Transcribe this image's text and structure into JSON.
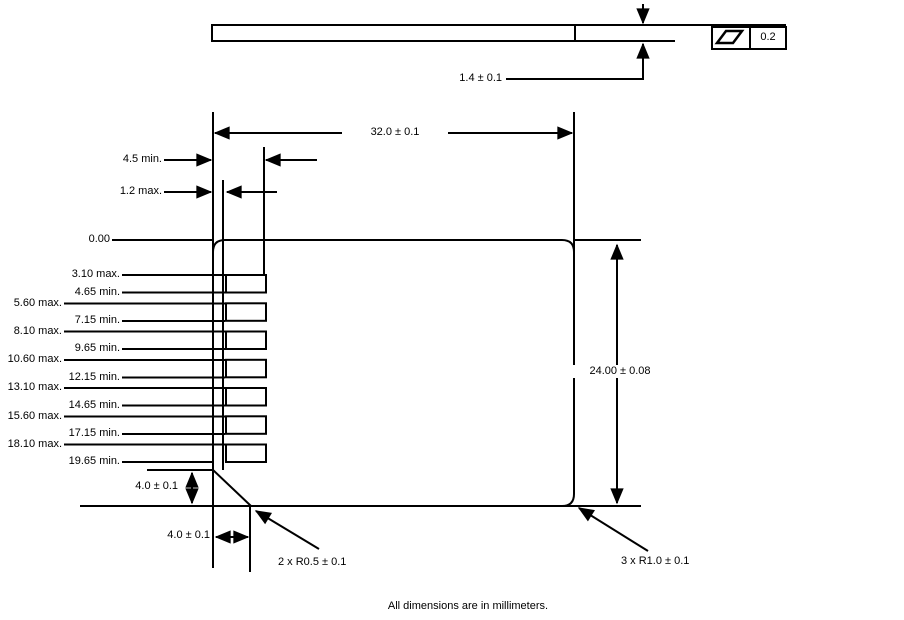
{
  "note": "All dimensions are in millimeters.",
  "colors": {
    "line": "#000000",
    "background": "#ffffff"
  },
  "side_view": {
    "thickness_dim": "1.4 ± 0.1",
    "flatness_symbol": "flatness-parallelogram",
    "flatness_tolerance": "0.2"
  },
  "front_view": {
    "width_dim": "32.0 ± 0.1",
    "height_dim": "24.00 ± 0.08",
    "contact_depth_dim": "4.5 min.",
    "contact_clearance_dim": "1.2 max.",
    "origin_label": "0.00",
    "chamfer_height_dim": "4.0 ± 0.1",
    "chamfer_width_dim": "4.0 ± 0.1",
    "chamfer_radius_note": "2 x R0.5 ± 0.1",
    "corner_radius_note": "3 x R1.0 ± 0.1",
    "contact_rows": [
      {
        "label": "3.10 max.",
        "mm": 3.1,
        "indent": true
      },
      {
        "label": "4.65 min.",
        "mm": 4.65,
        "indent": true
      },
      {
        "label": "5.60 max.",
        "mm": 5.6,
        "indent": false
      },
      {
        "label": "7.15 min.",
        "mm": 7.15,
        "indent": true
      },
      {
        "label": "8.10 max.",
        "mm": 8.1,
        "indent": false
      },
      {
        "label": "9.65 min.",
        "mm": 9.65,
        "indent": true
      },
      {
        "label": "10.60 max.",
        "mm": 10.6,
        "indent": false
      },
      {
        "label": "12.15 min.",
        "mm": 12.15,
        "indent": true
      },
      {
        "label": "13.10 max.",
        "mm": 13.1,
        "indent": false
      },
      {
        "label": "14.65 min.",
        "mm": 14.65,
        "indent": true
      },
      {
        "label": "15.60 max.",
        "mm": 15.6,
        "indent": false
      },
      {
        "label": "17.15 min.",
        "mm": 17.15,
        "indent": true
      },
      {
        "label": "18.10 max.",
        "mm": 18.1,
        "indent": false
      },
      {
        "label": "19.65 min.",
        "mm": 19.65,
        "indent": true
      }
    ],
    "pads_mm": [
      [
        3.1,
        4.65
      ],
      [
        5.6,
        7.15
      ],
      [
        8.1,
        9.65
      ],
      [
        10.6,
        12.15
      ],
      [
        13.1,
        14.65
      ],
      [
        15.6,
        17.15
      ],
      [
        18.1,
        19.65
      ]
    ]
  }
}
